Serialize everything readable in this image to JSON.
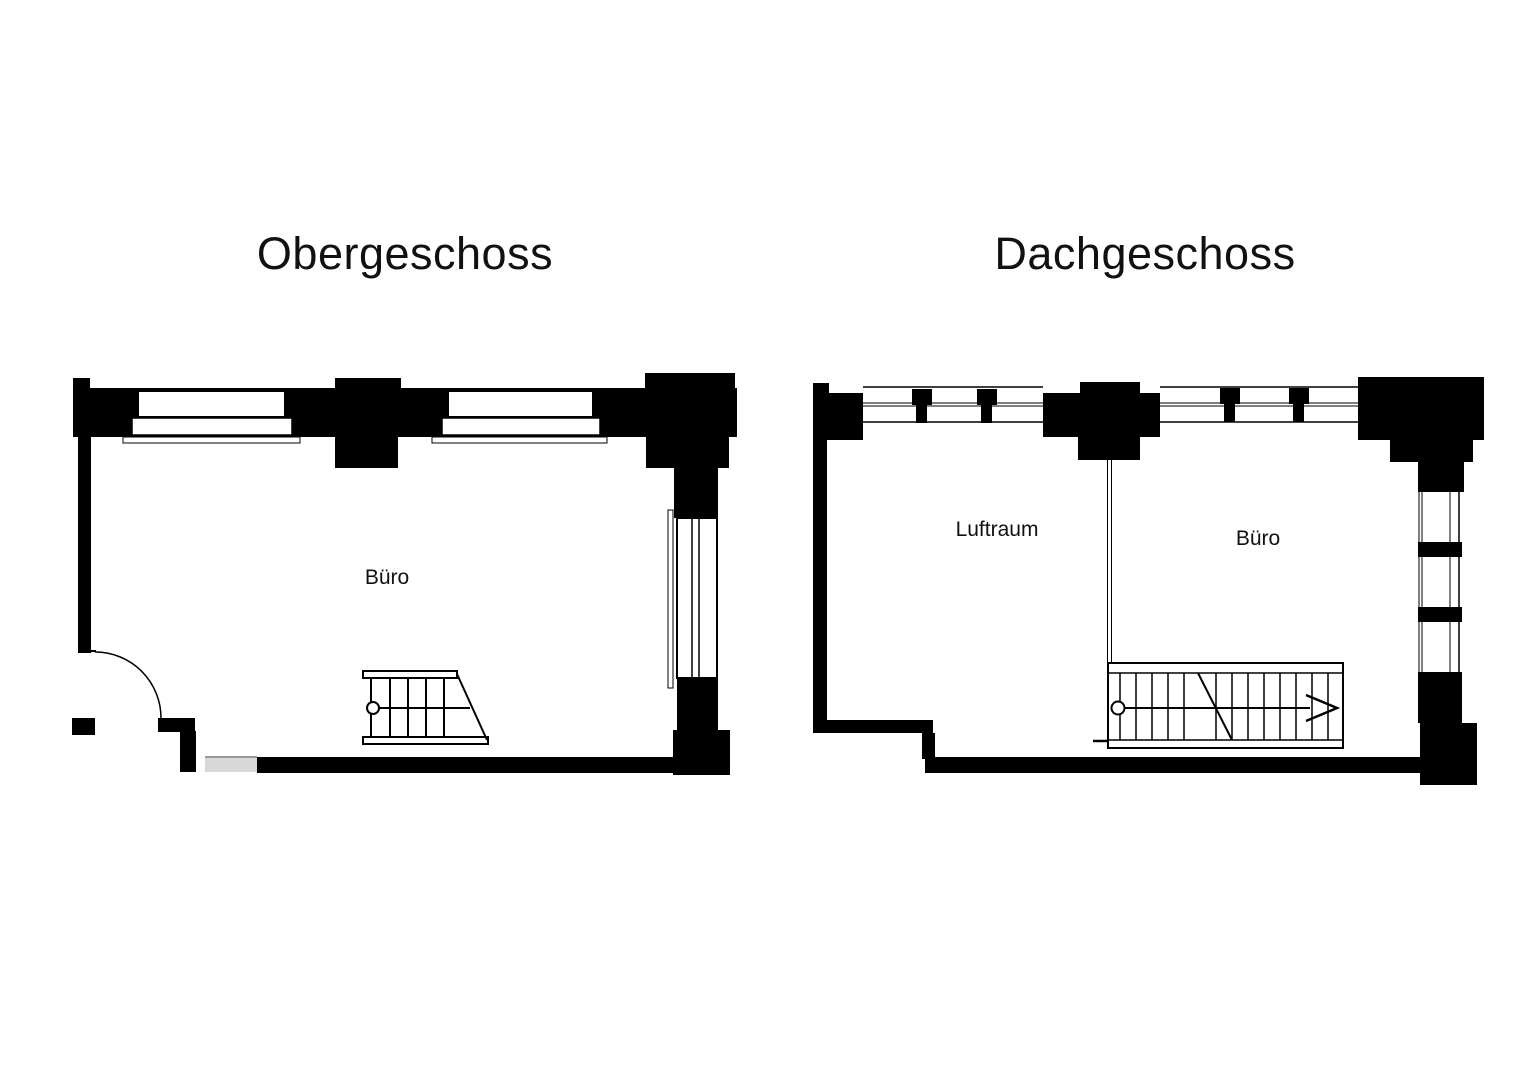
{
  "document": {
    "background": "#ffffff"
  },
  "colors": {
    "wall": "#000000",
    "line": "#000000",
    "window_fill": "#ffffff",
    "door_threshold_gray": "#d8d8d8",
    "threshold_edge_gray": "#999999",
    "text": "#111111"
  },
  "plans": [
    {
      "title": "Obergeschoss",
      "rooms": [
        {
          "label": "Büro"
        }
      ]
    },
    {
      "title": "Dachgeschoss",
      "rooms": [
        {
          "label": "Luftraum"
        },
        {
          "label": "Büro"
        }
      ]
    }
  ]
}
